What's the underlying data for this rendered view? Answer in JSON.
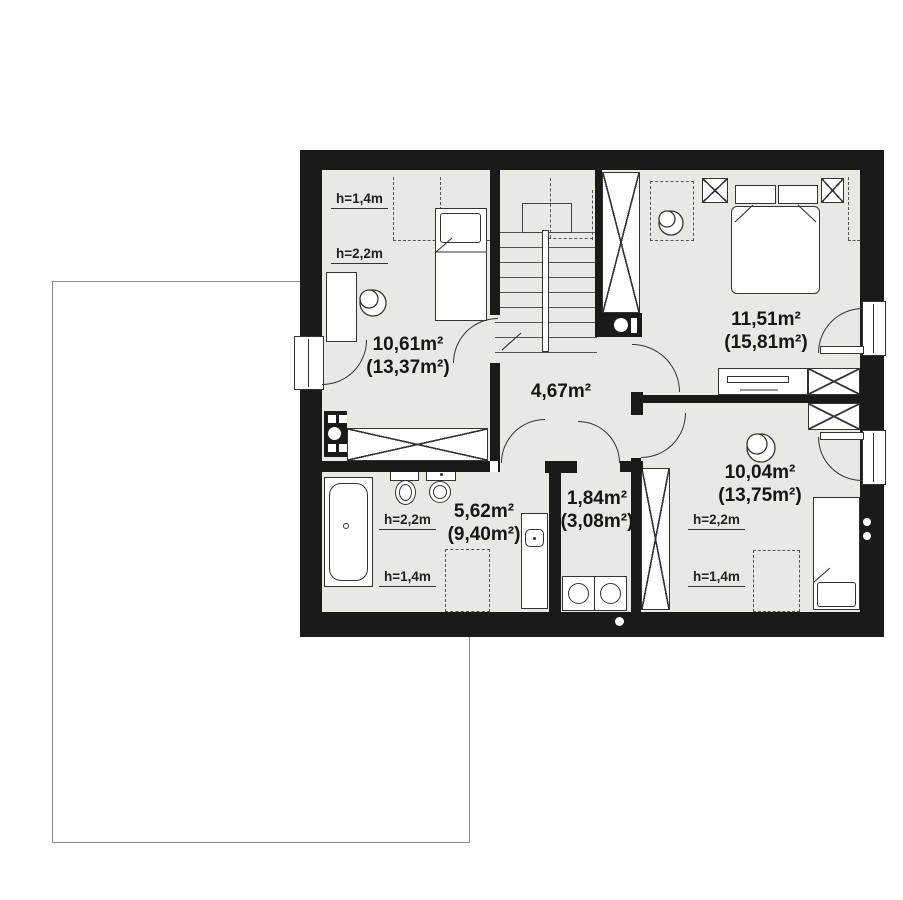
{
  "plan": {
    "type": "attic-floor-plan",
    "rooms": [
      {
        "key": "bedroom-left",
        "area": "10,61m²",
        "floor_area": "(13,37m²)"
      },
      {
        "key": "bedroom-top-right",
        "area": "11,51m²",
        "floor_area": "(15,81m²)"
      },
      {
        "key": "hallway",
        "area": "4,67m²",
        "floor_area": ""
      },
      {
        "key": "bathroom",
        "area": "5,62m²",
        "floor_area": "(9,40m²)"
      },
      {
        "key": "laundry",
        "area": "1,84m²",
        "floor_area": "(3,08m²)"
      },
      {
        "key": "bedroom-bottom-right",
        "area": "10,04m²",
        "floor_area": "(13,75m²)"
      }
    ],
    "height_labels": {
      "low": "h=1,4m",
      "high": "h=2,2m"
    },
    "colors": {
      "wall": "#1c1a19",
      "floor": "#e9e8e2",
      "line": "#333333",
      "outline": "#8c8c8c"
    }
  }
}
